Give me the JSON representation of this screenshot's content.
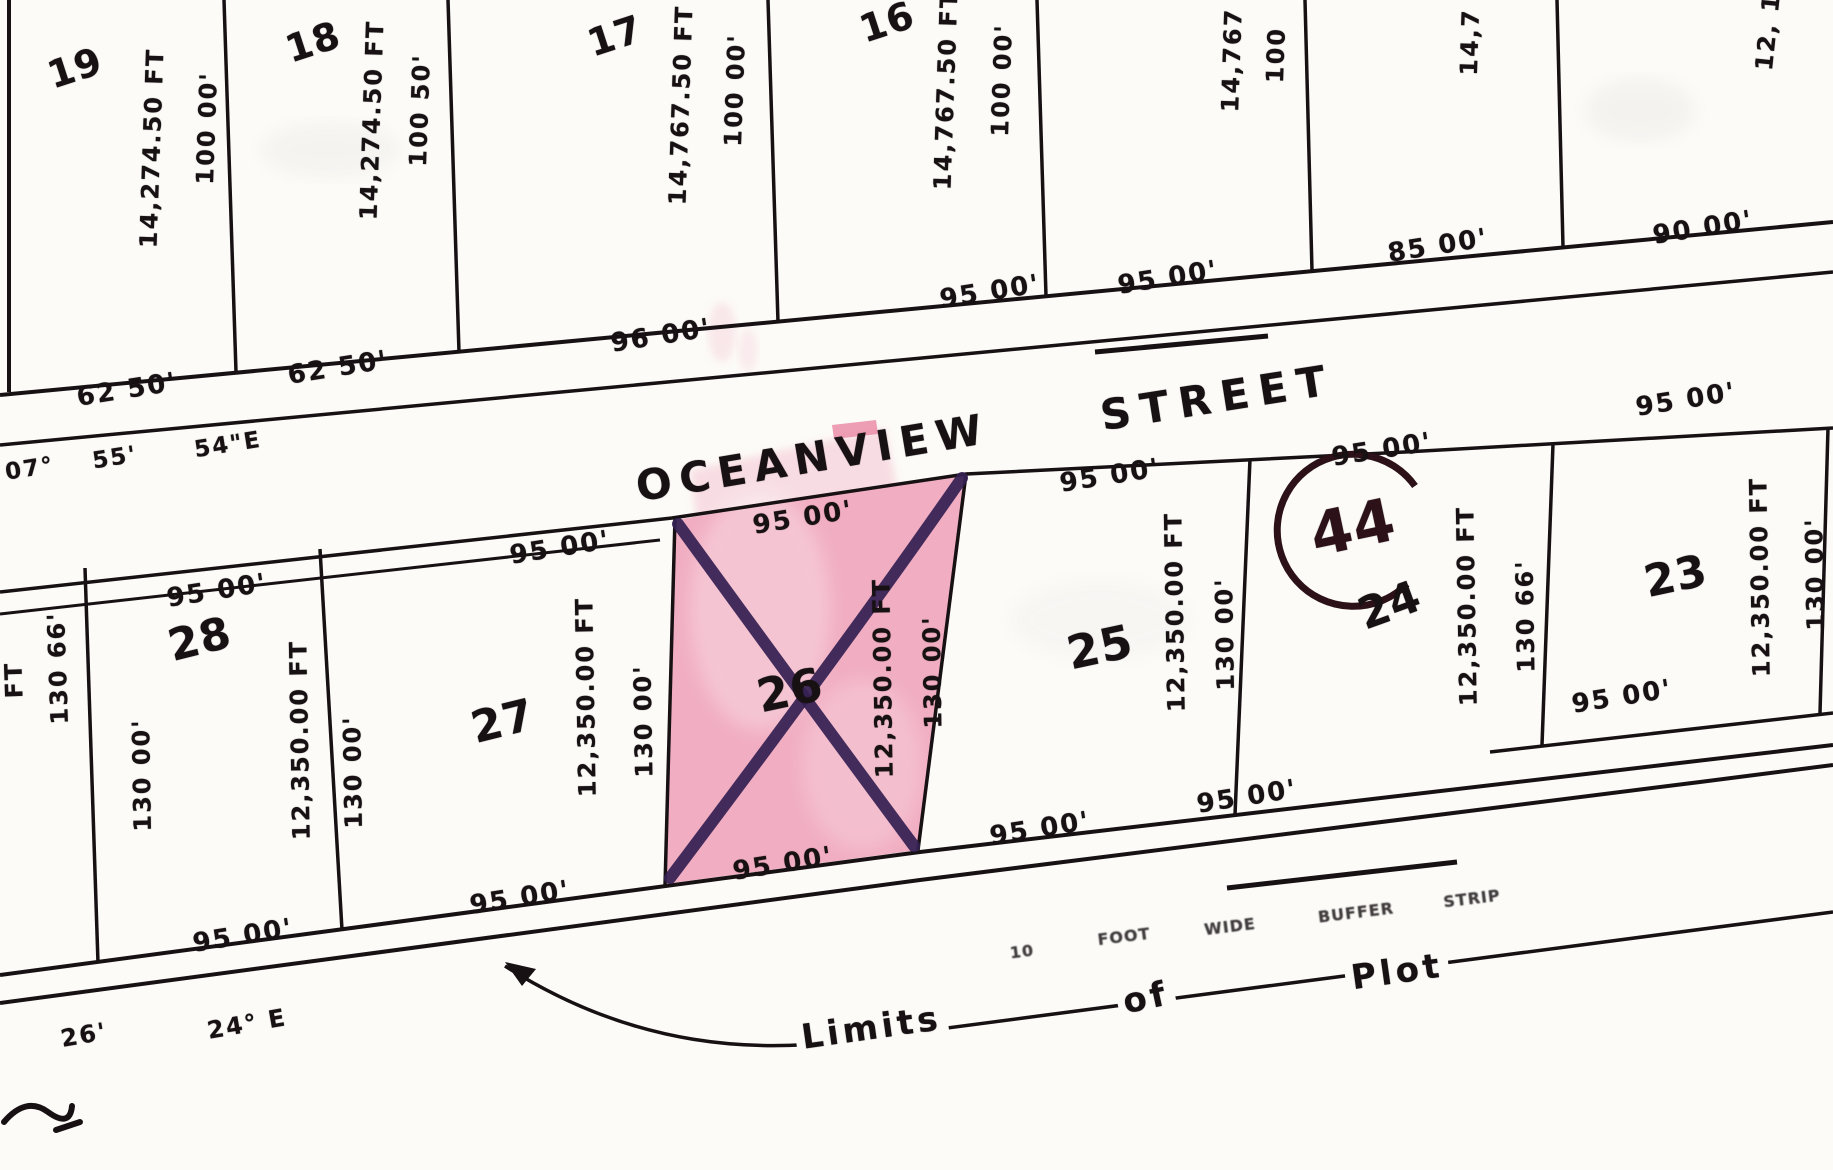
{
  "map": {
    "street": {
      "name_left": "OCEANVIEW",
      "name_right": "STREET"
    },
    "block": {
      "number": "44"
    },
    "bearings": {
      "street_left_deg": "07°",
      "street_left_min": "55'",
      "street_left_sec": "54\"E",
      "bottom_offset": "26'",
      "bottom_bearing": "24° E"
    },
    "limits_note": {
      "limits": "Limits",
      "of": "of",
      "plot": "Plot"
    },
    "buffer_note": {
      "words": [
        "10",
        "FOOT",
        "WIDE",
        "BUFFER",
        "STRIP"
      ]
    },
    "top_lots": [
      {
        "number": "19",
        "area": "14,274.50 FT",
        "depth": "100 00'",
        "frontage": "62 50'"
      },
      {
        "number": "18",
        "area": "14,274.50 FT",
        "depth": "100 50'",
        "frontage": "62 50'"
      },
      {
        "number": "17",
        "area": "14,767.50 FT",
        "depth": "100 00'",
        "frontage": "96 00'"
      },
      {
        "number": "16",
        "area": "14,767.50 FT",
        "depth": "100 00'",
        "frontage": "95 00'"
      },
      {
        "area": "14,767",
        "depth": "100",
        "frontage": "95 00'"
      },
      {
        "area": "14,7",
        "frontage": "85 00'"
      },
      {
        "area": "12, 1",
        "frontage": "90 00'"
      }
    ],
    "bottom_row": {
      "edge_lot": {
        "depth": "130 66'",
        "fragment": "FT"
      },
      "lots": [
        {
          "number": "28",
          "area": "12,350.00 FT",
          "depth_left": "130 00'",
          "depth_right": "130 00'",
          "frontage_top": "95 00'",
          "frontage_bottom": "95 00'"
        },
        {
          "number": "27",
          "area": "12,350.00 FT",
          "depth": "130 00'",
          "frontage_top": "95 00'",
          "frontage_bottom": "95 00'"
        },
        {
          "number": "26",
          "area": "12,350.00 FT",
          "depth": "130 00'",
          "frontage_top": "95 00'",
          "frontage_bottom": "95 00'",
          "highlighted": true
        },
        {
          "number": "25",
          "area": "12,350.00 FT",
          "depth": "130 00'",
          "frontage_top": "95 00'",
          "frontage_bottom": "95 00'"
        },
        {
          "number": "24",
          "area": "12,350.00 FT",
          "depth": "130 66'",
          "frontage_top": "95 00'",
          "frontage_bottom": "95 00'"
        },
        {
          "number": "23",
          "area": "12,350.00 FT",
          "depth": "130 00'",
          "frontage_top": "95 00'",
          "frontage_bottom": "95 00'"
        }
      ]
    },
    "colors": {
      "paper": "#fcfbf8",
      "ink": "#171114",
      "highlight_pink": "#f1aec2",
      "cross_purple": "#352052",
      "block_maroon": "#2c1118"
    }
  }
}
